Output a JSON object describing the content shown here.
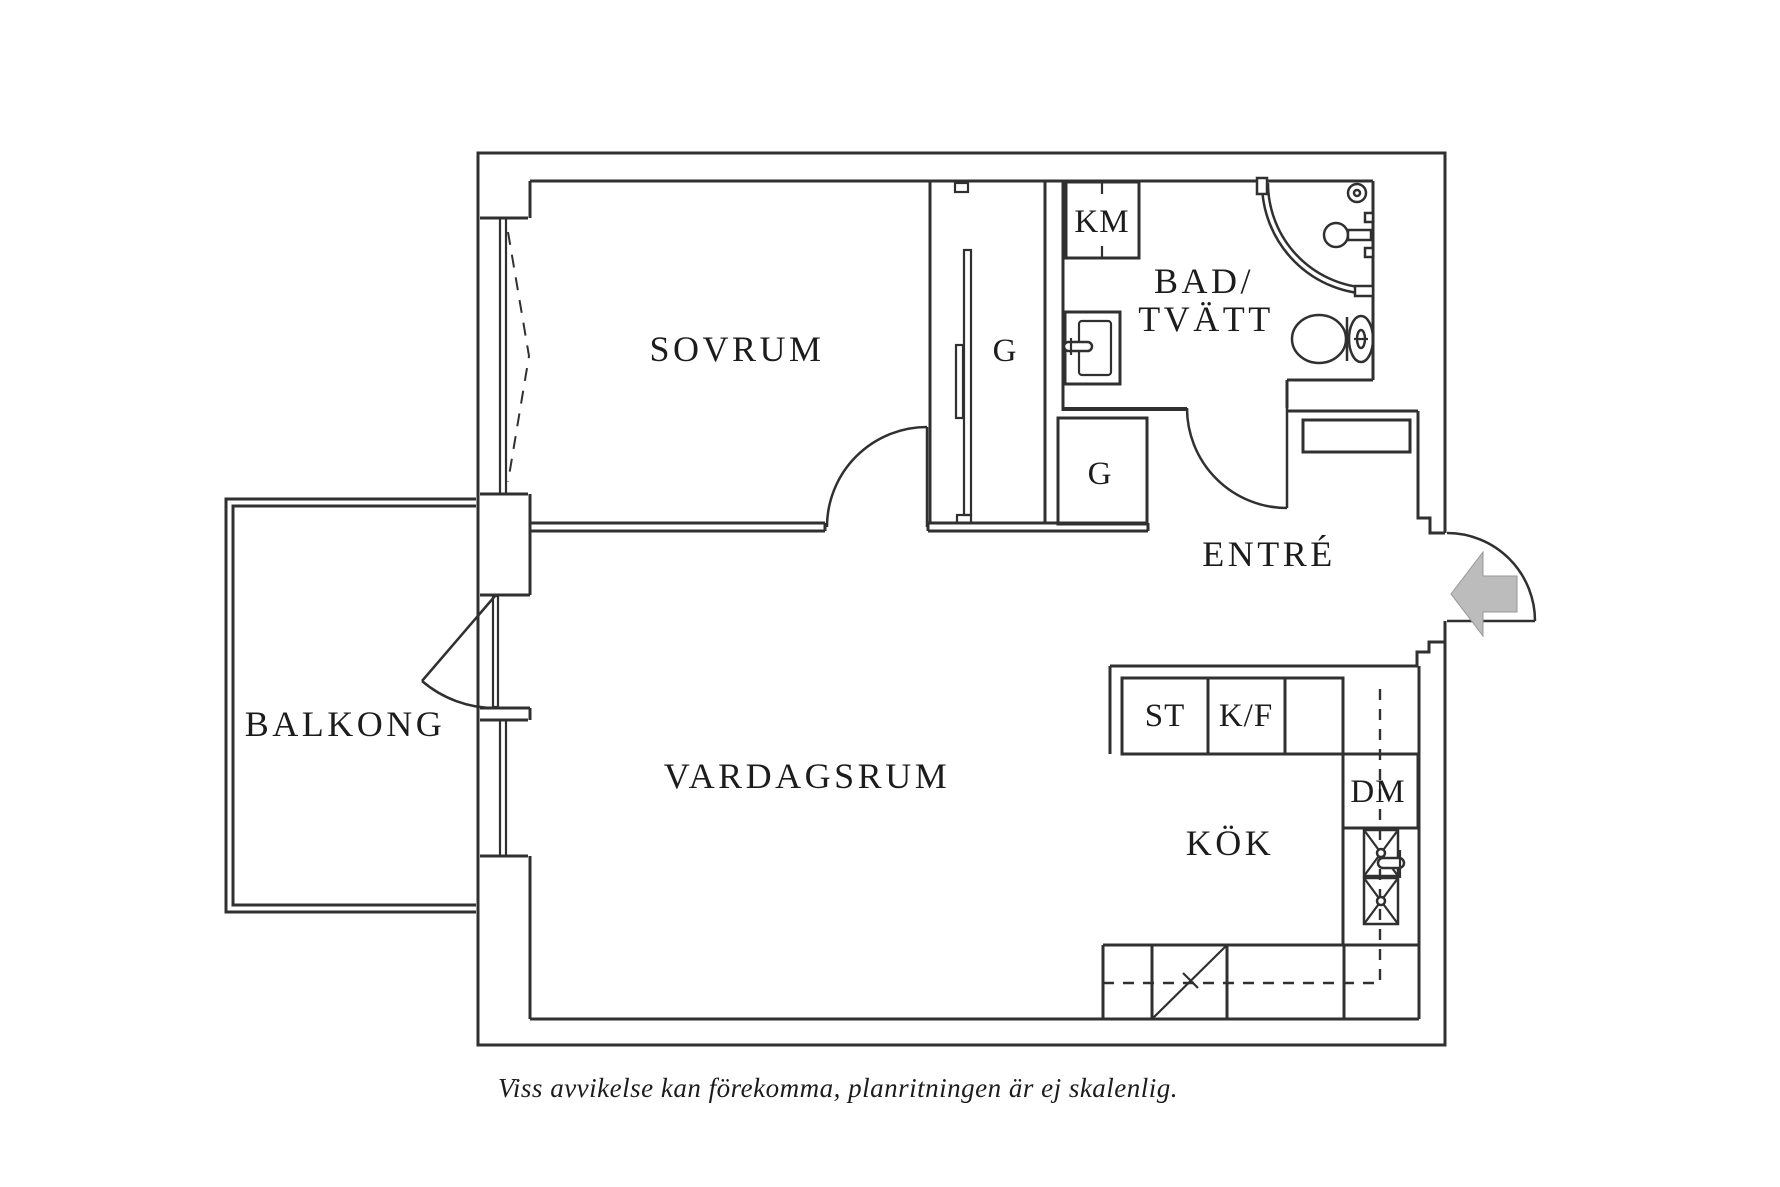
{
  "labels": {
    "bedroom": "SOVRUM",
    "wardrobe_bedroom": "G",
    "washing_machine": "KM",
    "bathroom_line1": "BAD/",
    "bathroom_line2": "TVÄTT",
    "wardrobe_hall": "G",
    "entry": "ENTRÉ",
    "balcony": "BALKONG",
    "living_room": "VARDAGSRUM",
    "pantry": "ST",
    "fridge_freezer": "K/F",
    "dishwasher": "DM",
    "kitchen": "KÖK",
    "caption": "Viss avvikelse kan förekomma, planritningen är ej skalenlig."
  },
  "colors": {
    "line": "#303030",
    "text": "#1c1c1c",
    "arrow_fill": "#bcbcbc",
    "background": "#ffffff"
  }
}
